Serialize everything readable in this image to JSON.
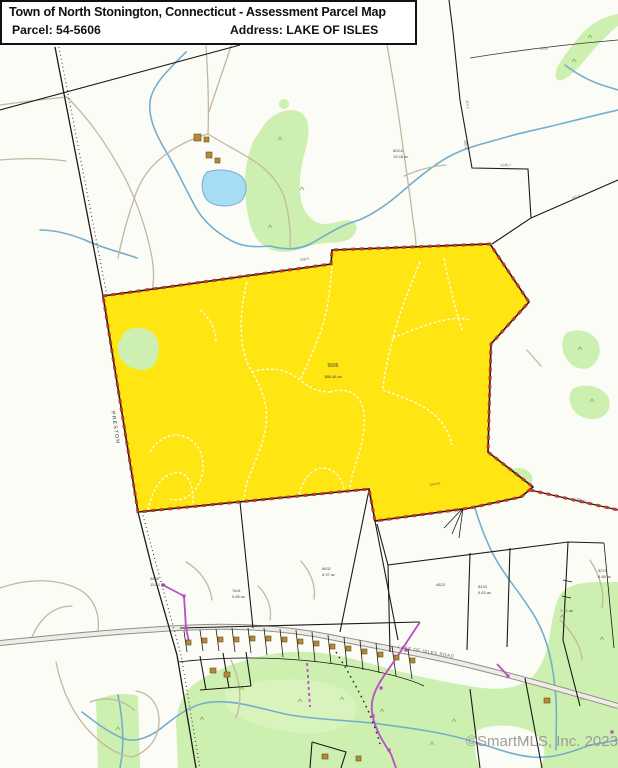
{
  "header": {
    "title": "Town of North Stonington, Connecticut - Assessment Parcel Map",
    "parcel_label": "Parcel: 54-5606",
    "address_label": "Address: LAKE OF ISLES"
  },
  "map": {
    "town_line_label": "PRESTON",
    "road_label": "LAKE OF ISLES ROAD",
    "subject_parcel": {
      "id_label": "5606",
      "area_label": "386.48 ac"
    },
    "watermark": "©SmartMLS, Inc. 2023",
    "colors": {
      "parcel_highlight": "#FFE612",
      "subject_dash": "#C03A28",
      "vegetation": "#CDEFAF",
      "water": "#74AECE",
      "pond_fill": "#A6DCF4",
      "boundary": "#1A1A1A",
      "trail": "#C2B89F",
      "utility": "#B94FC2",
      "road_fill": "#EFECE4",
      "road_casing": "#8F8F8F",
      "building": "#B5893B"
    },
    "small_labels": [
      {
        "text": "5846",
        "x": 150,
        "y": 580
      },
      {
        "text": "15.62 ac",
        "x": 150,
        "y": 586
      },
      {
        "text": "7641",
        "x": 232,
        "y": 592
      },
      {
        "text": "9.85 ac",
        "x": 232,
        "y": 598
      },
      {
        "text": "8632",
        "x": 322,
        "y": 570
      },
      {
        "text": "8.37 ac",
        "x": 322,
        "y": 576
      },
      {
        "text": "8443",
        "x": 478,
        "y": 588
      },
      {
        "text": "9.63 ac",
        "x": 478,
        "y": 594
      },
      {
        "text": "5274",
        "x": 598,
        "y": 572
      },
      {
        "text": "8.88 ac",
        "x": 598,
        "y": 578
      },
      {
        "text": "4823",
        "x": 436,
        "y": 586
      },
      {
        "text": "80CA",
        "x": 393,
        "y": 152
      },
      {
        "text": "19.48 ac",
        "x": 393,
        "y": 158
      },
      {
        "text": "7.12 ac",
        "x": 560,
        "y": 612
      },
      {
        "text": "414.2",
        "x": 466,
        "y": 100,
        "rot": 84,
        "cls": "dim"
      },
      {
        "text": "389.6",
        "x": 464,
        "y": 140,
        "rot": 84,
        "cls": "dim"
      },
      {
        "text": "1248.7",
        "x": 500,
        "y": 166,
        "rot": 2,
        "cls": "dim"
      },
      {
        "text": "182.4",
        "x": 572,
        "y": 200,
        "rot": -24,
        "cls": "dim"
      },
      {
        "text": "260±",
        "x": 540,
        "y": 50,
        "rot": -4,
        "cls": "dim"
      },
      {
        "text": "644.97",
        "x": 430,
        "y": 486,
        "rot": -8,
        "cls": "dim"
      },
      {
        "text": "356.61",
        "x": 576,
        "y": 500,
        "rot": 14,
        "cls": "dim"
      },
      {
        "text": "308.9",
        "x": 300,
        "y": 261,
        "rot": -8,
        "cls": "dim"
      }
    ]
  }
}
